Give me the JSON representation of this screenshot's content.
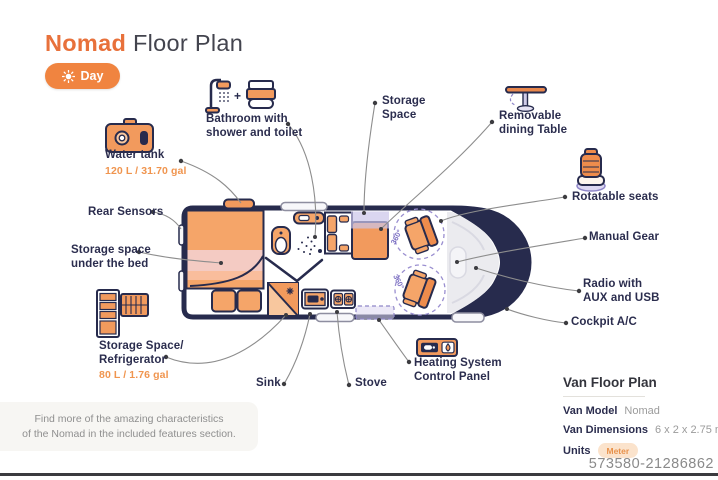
{
  "header": {
    "title_accent": "Nomad",
    "title_rest": "Floor Plan",
    "mode_toggle": {
      "label": "Day",
      "icon": "sun-icon"
    }
  },
  "floorplan": {
    "rotation_label": "360°",
    "callouts": {
      "bathroom": {
        "line1": "Bathroom with",
        "line2": "shower and toilet",
        "plus": "+",
        "icons": [
          "shower-icon",
          "toilet-icon"
        ]
      },
      "storage_space": {
        "line1": "Storage",
        "line2": "Space"
      },
      "dining_table": {
        "line1": "Removable",
        "line2": "dining Table",
        "icon": "dining-table-icon"
      },
      "water_tank": {
        "label": "Water tank",
        "value": "120 L / 31.70 gal",
        "icon": "water-tank-icon"
      },
      "rear_sensors": {
        "label": "Rear Sensors"
      },
      "storage_under_bed": {
        "line1": "Storage space",
        "line2": "under the bed"
      },
      "rotatable_seats": {
        "label": "Rotatable seats",
        "icon": "rotatable-seat-icon"
      },
      "manual_gear": {
        "label": "Manual Gear"
      },
      "radio": {
        "line1": "Radio with",
        "line2": "AUX and USB"
      },
      "cockpit_ac": {
        "label": "Cockpit A/C"
      },
      "fridge": {
        "line1": "Storage Space/",
        "line2": "Refrigerator",
        "value": "80 L / 1.76 gal",
        "icon": "refrigerator-icon"
      },
      "sink": {
        "label": "Sink"
      },
      "stove": {
        "label": "Stove"
      },
      "heating": {
        "line1": "Heating System",
        "line2": "Control Panel",
        "icon": "heating-control-icon"
      }
    }
  },
  "info_panel": {
    "title": "Van Floor Plan",
    "rows": [
      {
        "label": "Van Model",
        "value": "Nomad"
      },
      {
        "label": "Van Dimensions",
        "value": "6 x 2 x 2.75 m"
      },
      {
        "label": "Units",
        "value": "Meter"
      }
    ]
  },
  "note": {
    "line1": "Find more of the amazing characteristics",
    "line2": "of the Nomad in the included features section."
  },
  "watermark": "573580-21286862",
  "colors": {
    "accent_orange": "#E8713B",
    "furniture_orange": "#F5A569",
    "outline_navy": "#272B4D",
    "lavender": "#8F86C8",
    "pink_stripe": "#F4CBC3",
    "gray_text": "#8D8D8D"
  }
}
